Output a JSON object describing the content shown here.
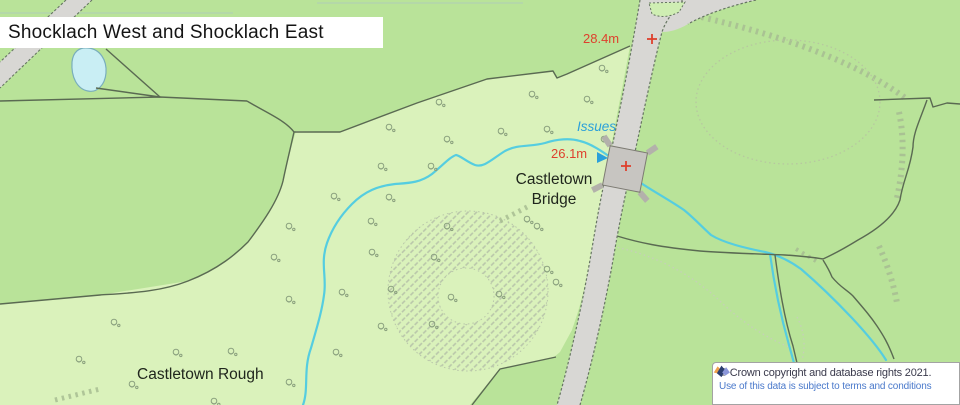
{
  "map": {
    "title": "Shocklach West and Shocklach East",
    "labels": {
      "issues": "Issues",
      "bridge_line1": "Castletown",
      "bridge_line2": "Bridge",
      "rough": "Castletown Rough"
    },
    "spot_heights": [
      {
        "label": "28.4m"
      },
      {
        "label": "26.1m"
      }
    ],
    "attribution": {
      "copyright": "© Crown copyright and database rights 2021.",
      "terms": "Use of this data is subject to terms and conditions"
    },
    "colors": {
      "field_green": "#b9e399",
      "rough_green": "#daf2bb",
      "island_green": "#cfeeb3",
      "road_gray": "#d8d7d4",
      "bridge_gray": "#c7c5c1",
      "boundary_dark": "#5a6a52",
      "stream_cyan": "#55cde0",
      "pond_fill": "#c9eef4",
      "pond_edge": "#79aebc",
      "spot_red": "#de402d",
      "issues_blue": "#2ba0da",
      "link_blue": "#4a79cb",
      "attribution_text": "#3a3a4c",
      "hachure": "#a7bd92",
      "contour_dot": "#c6cfba"
    },
    "trees": [
      [
        385,
        123
      ],
      [
        435,
        98
      ],
      [
        528,
        90
      ],
      [
        583,
        95
      ],
      [
        497,
        127
      ],
      [
        543,
        125
      ],
      [
        443,
        135
      ],
      [
        600,
        135
      ],
      [
        598,
        64
      ],
      [
        377,
        162
      ],
      [
        427,
        162
      ],
      [
        330,
        192
      ],
      [
        385,
        193
      ],
      [
        285,
        222
      ],
      [
        367,
        217
      ],
      [
        443,
        222
      ],
      [
        523,
        215
      ],
      [
        533,
        222
      ],
      [
        368,
        248
      ],
      [
        430,
        253
      ],
      [
        447,
        293
      ],
      [
        495,
        290
      ],
      [
        428,
        320
      ],
      [
        338,
        288
      ],
      [
        387,
        285
      ],
      [
        285,
        295
      ],
      [
        377,
        322
      ],
      [
        172,
        348
      ],
      [
        227,
        347
      ],
      [
        332,
        348
      ],
      [
        128,
        380
      ],
      [
        285,
        378
      ],
      [
        210,
        397
      ],
      [
        270,
        253
      ],
      [
        543,
        265
      ],
      [
        552,
        278
      ],
      [
        110,
        318
      ],
      [
        75,
        355
      ]
    ]
  }
}
